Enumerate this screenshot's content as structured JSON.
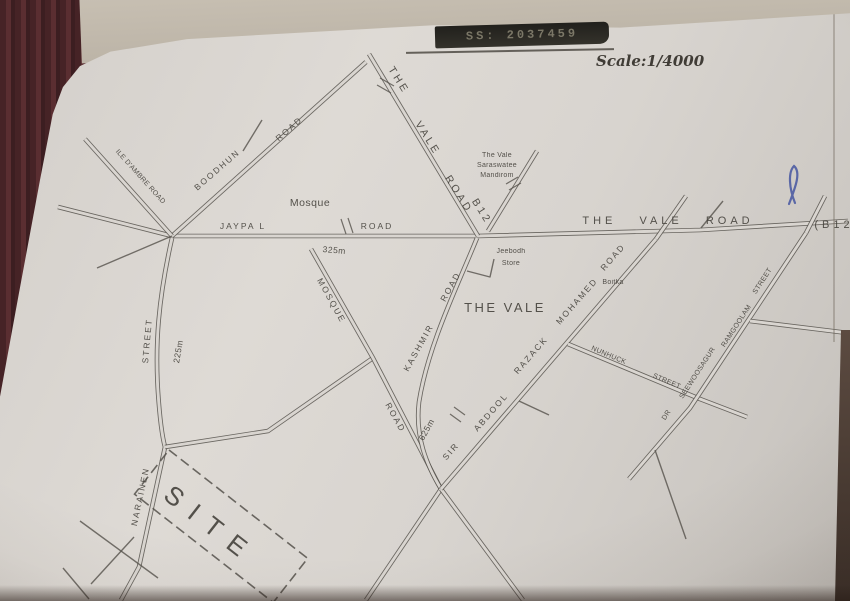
{
  "photo": {
    "stamp_number": "SS: 2037459",
    "scale_note": "Scale:1/4000",
    "colors": {
      "backdrop": "#462326",
      "paper": "#dad6d1",
      "ink": "#55514b",
      "pen_mark": "#3c4d9e"
    }
  },
  "map": {
    "area_label": "THE VALE",
    "site_label": "SITE",
    "roads": {
      "the_vale_road_diagonal": {
        "words": [
          "THE",
          "VALE",
          "ROAD",
          "B12"
        ]
      },
      "the_vale_road_east": {
        "words": [
          "THE VALE ROAD",
          "(B12"
        ]
      },
      "jaypal_road": {
        "words": [
          "JAYPA L",
          "ROAD"
        ]
      },
      "boodhun_road": {
        "words": [
          "BOODHUN",
          "ROAD"
        ]
      },
      "ile_dambre_road": {
        "words": [
          "ILE D'AMBRE ROAD"
        ]
      },
      "mosque_road": {
        "words": [
          "MOSQUE",
          "ROAD"
        ]
      },
      "kashmir_road": {
        "words": [
          "KASHMIR",
          "ROAD"
        ]
      },
      "sir_abdool_razack_mohamed_road": {
        "words": [
          "SIR",
          "ABDOOL",
          "RAZACK",
          "MOHAMED",
          "ROAD"
        ]
      },
      "nunhuck_street": {
        "words": [
          "NUNHUCK",
          "STREET"
        ]
      },
      "dr_seewoosagur_ramgoolam_street": {
        "words": [
          "DR",
          "SEEWOOSAGUR",
          "RAMGOOLAM",
          "STREET"
        ]
      },
      "street_west": {
        "words": [
          "STREET"
        ]
      },
      "narainen_street": {
        "words": [
          "NARAINEN"
        ]
      }
    },
    "places": {
      "mosque": "Mosque",
      "mandiram": [
        "The Vale",
        "Saraswatee",
        "Mandirom"
      ],
      "jeebodh_store": [
        "Jeebodh",
        "Store"
      ],
      "boitka": "Boitka"
    },
    "distances": {
      "jaypal": "325m",
      "street_west": "225m",
      "kashmir": "625m"
    }
  }
}
